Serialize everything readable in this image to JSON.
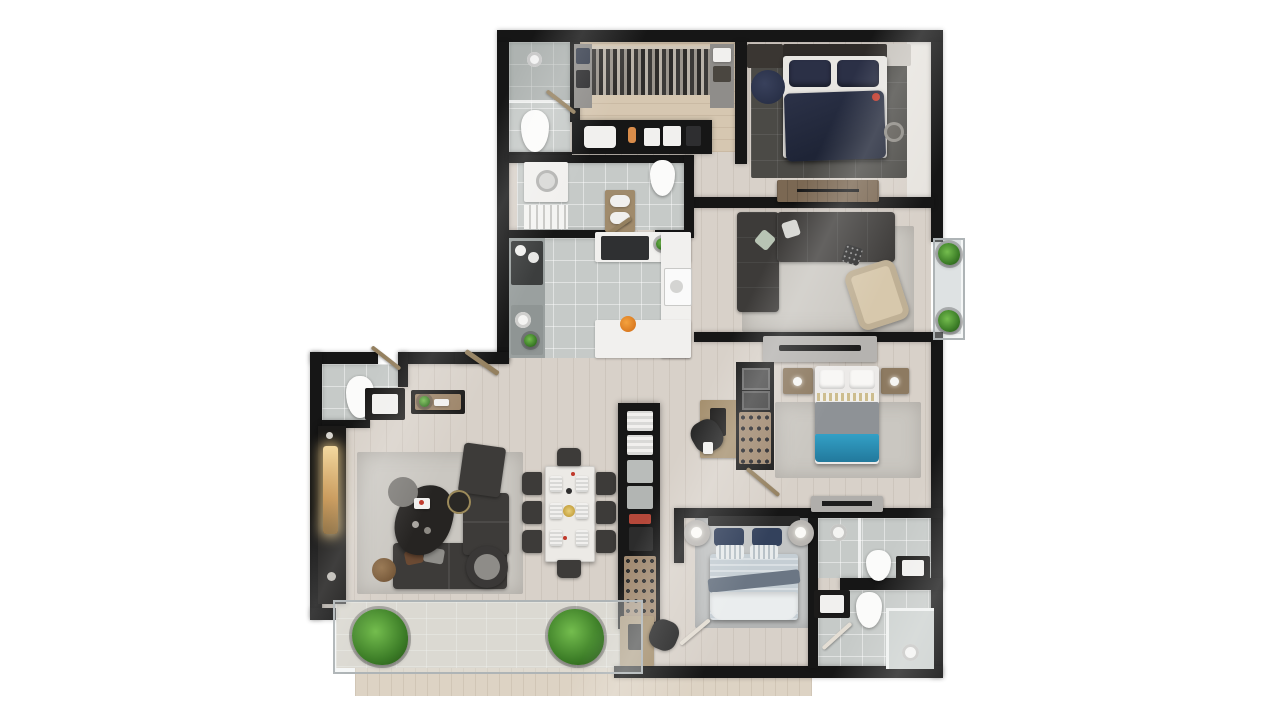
{
  "scene": {
    "type": "3d-rendered-floor-plan",
    "view": "top-down",
    "background_color": "#ffffff",
    "visible_text": "none"
  },
  "palette": {
    "walls": "#161616",
    "wood_floor": "#d8d1c9",
    "terrace_deck": "#ddd3c4",
    "tile_floor": "#c6cac8",
    "dark_rug": "#4b4a46",
    "light_rug": "#cac7c1",
    "sofa_dark_gray": "#3d3b39",
    "bed_navy": "#272e44",
    "throw_teal": "#2a8cb4",
    "bed_striped_blue": "#c5ced4",
    "armchair_beige": "#d7c8ac",
    "wood_furniture": "#94805f",
    "plant_green": "#3c7d27",
    "fireplace_glow": "#e8c886",
    "fruit_bowl_orange": "#e8862a",
    "accent_red": "#c0392b"
  },
  "rooms": [
    {
      "name": "walk-in-closet",
      "furniture": [
        "hanging-clothes-rail",
        "shelf-units",
        "vanity-counter-with-sink",
        "toiletries"
      ]
    },
    {
      "name": "bathroom-1",
      "furniture": [
        "shower",
        "toilet",
        "glass-partition"
      ]
    },
    {
      "name": "bathroom-2",
      "furniture": [
        "washer",
        "slatted-shower-floor",
        "towel-shelf",
        "toilet"
      ]
    },
    {
      "name": "master-bedroom",
      "furniture": [
        "double-bed-navy",
        "nightstands",
        "pouf",
        "dresser-console",
        "dark-grid-rug"
      ]
    },
    {
      "name": "family-room",
      "furniture": [
        "l-shaped-sectional-sofa",
        "light-rug",
        "beige-armchair",
        "tv-console"
      ]
    },
    {
      "name": "side-balcony",
      "furniture": [
        "planter",
        "planter"
      ]
    },
    {
      "name": "kitchen",
      "furniture": [
        "cooktop-counter",
        "sink-counter",
        "white-island",
        "range",
        "wall-oven",
        "fruit-bowl"
      ]
    },
    {
      "name": "powder-room",
      "furniture": [
        "toilet",
        "black-vanity-sink"
      ]
    },
    {
      "name": "entry-console",
      "furniture": [
        "console-table",
        "plant",
        "trays"
      ]
    },
    {
      "name": "living-dining-room",
      "furniture": [
        "media-wall-with-fireplace",
        "sofa",
        "loveseat",
        "armchair",
        "round-swivel-chair",
        "organic-coffee-tables",
        "side-table",
        "pouf",
        "dining-table",
        "dining-chairs-x8",
        "place-settings"
      ]
    },
    {
      "name": "hallway",
      "furniture": [
        "linen-closet",
        "storage-boxes",
        "shoe-rack",
        "study-desk",
        "office-chair"
      ]
    },
    {
      "name": "bedroom-2",
      "furniture": [
        "bed-gray-teal",
        "wood-nightstands",
        "closet-shoe-shelf",
        "picture-frames",
        "tv-console"
      ]
    },
    {
      "name": "bedroom-3",
      "furniture": [
        "bed-striped-blue",
        "round-nightstands-with-lamps",
        "desk",
        "office-chair"
      ]
    },
    {
      "name": "bathroom-3",
      "furniture": [
        "shower-head",
        "toilet",
        "black-vanity-sink"
      ]
    },
    {
      "name": "bathroom-4",
      "furniture": [
        "black-vanity-sink",
        "toilet",
        "glass-shower",
        "shower-head"
      ]
    },
    {
      "name": "terrace",
      "furniture": [
        "planter",
        "planter",
        "glass-railing",
        "wood-deck"
      ]
    }
  ],
  "counts": {
    "bedrooms": 3,
    "bathrooms": 5,
    "balconies": 2,
    "dining_chairs": 8
  }
}
